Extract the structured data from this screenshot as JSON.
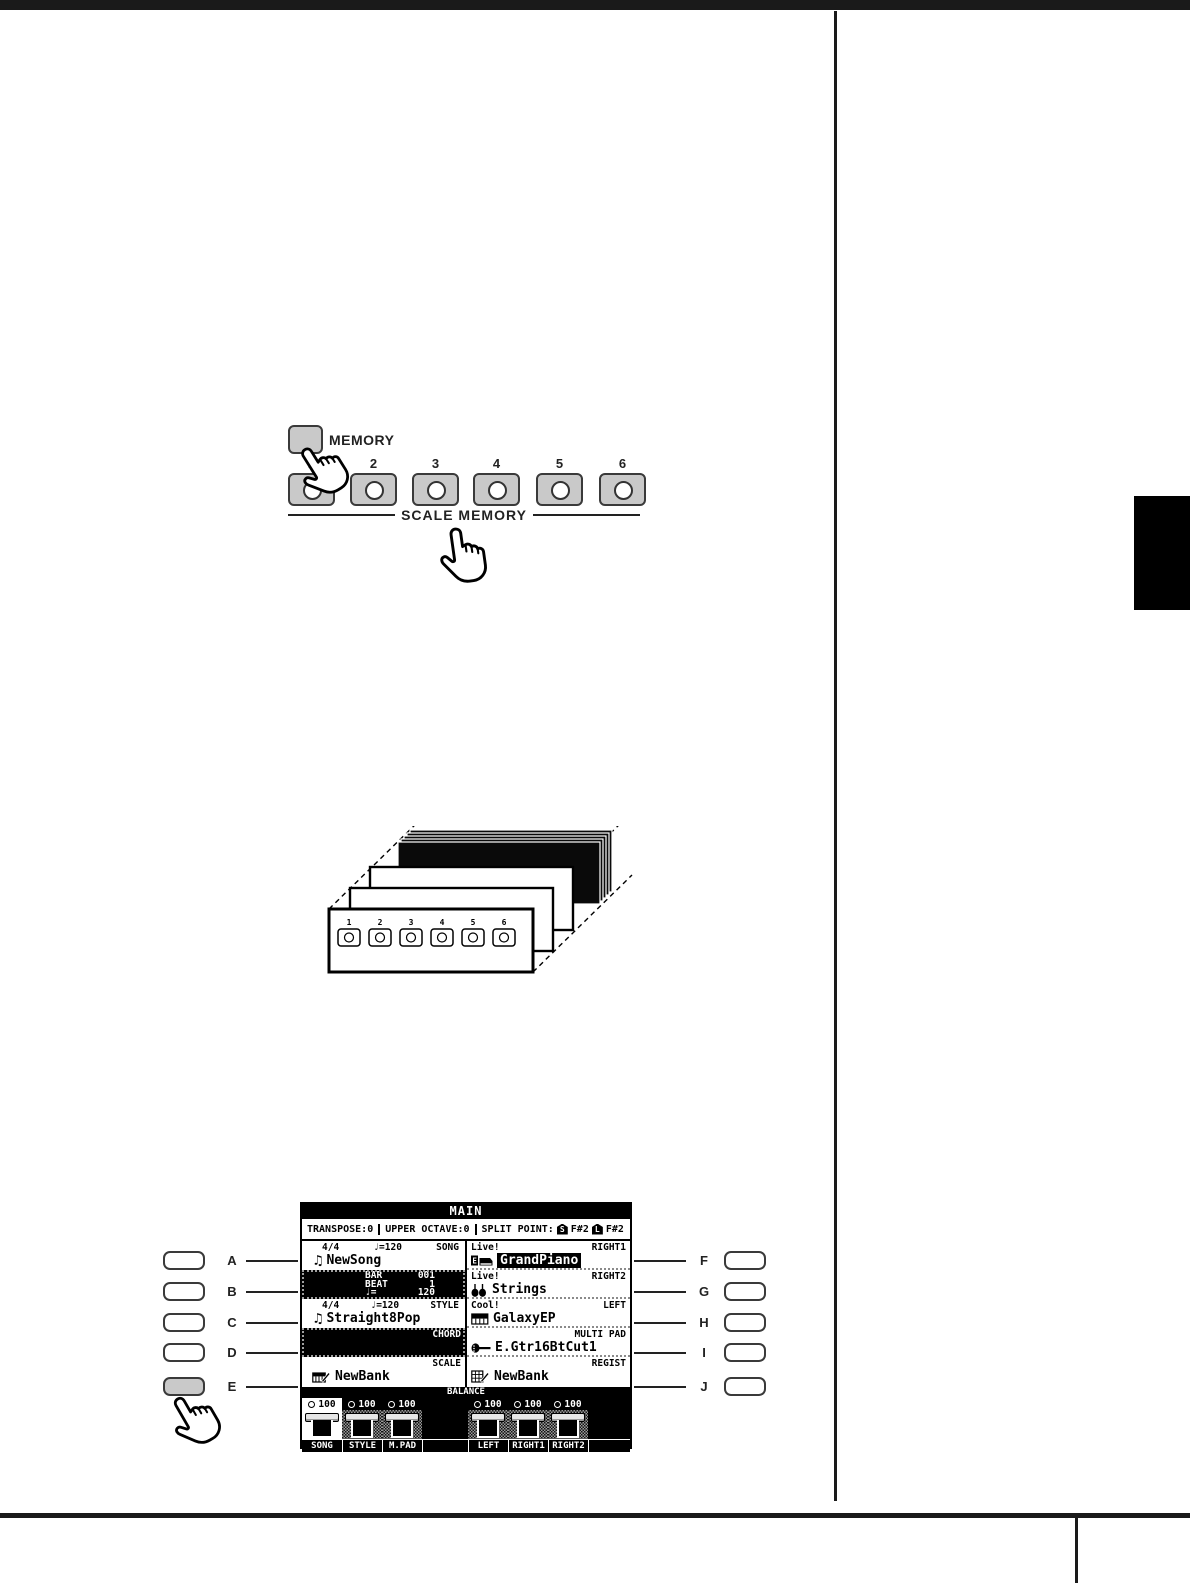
{
  "panel": {
    "memory_label": "MEMORY",
    "group_label": "SCALE MEMORY",
    "buttons": [
      "1",
      "2",
      "3",
      "4",
      "5",
      "6"
    ]
  },
  "stack": {
    "buttons": [
      "1",
      "2",
      "3",
      "4",
      "5",
      "6"
    ]
  },
  "display": {
    "title": "MAIN",
    "status": {
      "transpose": "TRANSPOSE:0",
      "upper_octave": "UPPER OCTAVE:0",
      "split_label": "SPLIT POINT:",
      "split_s_tag": "S",
      "split_s_value": "F#2",
      "split_l_tag": "L",
      "split_l_value": "F#2"
    },
    "song": {
      "meter": "4/4",
      "tempo": "♩=120",
      "label": "SONG",
      "name": "NewSong"
    },
    "transport": {
      "bar_label": "BAR",
      "bar_value": "001",
      "beat_label": "BEAT",
      "beat_value": "1",
      "tempo_label": "♩=",
      "tempo_value": "120"
    },
    "style": {
      "meter": "4/4",
      "tempo": "♩=120",
      "label": "STYLE",
      "name": "Straight8Pop"
    },
    "chord_label": "CHORD",
    "scale": {
      "label": "SCALE",
      "name": "NewBank"
    },
    "right1": {
      "tag": "Live!",
      "label": "RIGHT1",
      "name": "GrandPiano"
    },
    "right2": {
      "tag": "Live!",
      "label": "RIGHT2",
      "name": "Strings"
    },
    "left": {
      "tag": "Cool!",
      "label": "LEFT",
      "name": "GalaxyEP"
    },
    "multipad": {
      "label": "MULTI PAD",
      "name": "E.Gtr16BtCut1"
    },
    "regist": {
      "label": "REGIST",
      "name": "NewBank"
    },
    "balance": {
      "label": "BALANCE",
      "channels": [
        {
          "name": "SONG",
          "value": "100"
        },
        {
          "name": "STYLE",
          "value": "100"
        },
        {
          "name": "M.PAD",
          "value": "100"
        },
        {
          "name": "LEFT",
          "value": "100"
        },
        {
          "name": "RIGHT1",
          "value": "100"
        },
        {
          "name": "RIGHT2",
          "value": "100"
        }
      ]
    }
  },
  "display_buttons": {
    "left": [
      "A",
      "B",
      "C",
      "D",
      "E"
    ],
    "right": [
      "F",
      "G",
      "H",
      "I",
      "J"
    ]
  },
  "colors": {
    "button_gray": "#c9c9c9",
    "lcd_ink": "#000000"
  }
}
